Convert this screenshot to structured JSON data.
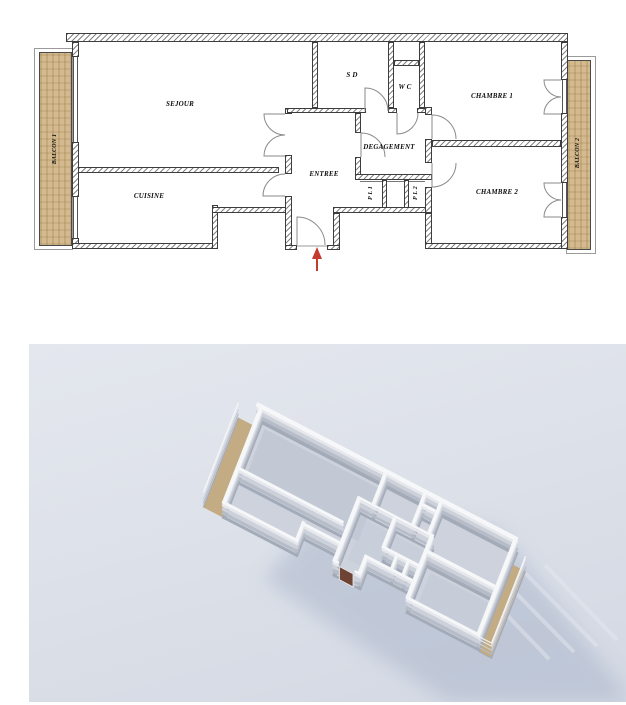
{
  "plan": {
    "rooms": {
      "sejour": "SEJOUR",
      "cuisine": "CUISINE",
      "sd": "S D",
      "wc": "W C",
      "chambre1": "CHAMBRE 1",
      "chambre2": "CHAMBRE 2",
      "degagement": "DEGAGEMENT",
      "entree": "ENTREE",
      "pl1": "P L 1",
      "pl2": "P L 2",
      "balcon1": "BALCON 1",
      "balcon2": "BALCON 2"
    },
    "colors": {
      "balcony_floor": "#d4ba8e",
      "wall_edge": "#3d3d3d",
      "hatch": "#9a9a9a",
      "door_arc": "#8a8a8a",
      "entrance_arrow": "#c43a2e"
    }
  },
  "render3d": {
    "colors": {
      "background_top": "#e4e7ee",
      "background_bottom": "#d3d8e3",
      "wall_top": "#f6f7f9",
      "wall_side": "#a3aab8",
      "floor": "#cdd2dc",
      "shadow": "#a9b5cb",
      "balcony_floor": "#c3ac83",
      "entrance_door": "#6e4336"
    }
  }
}
